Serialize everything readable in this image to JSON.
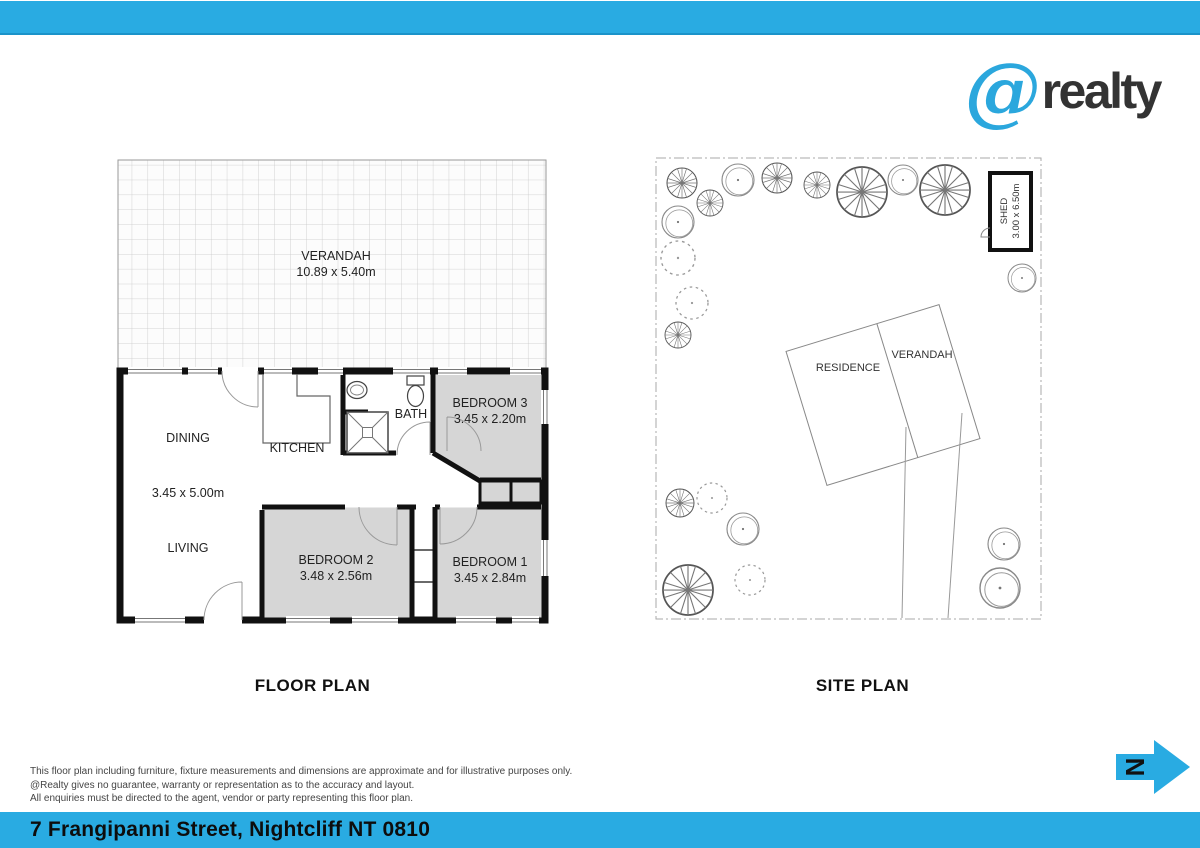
{
  "header": {
    "logo_at": "@",
    "logo_text": "realty"
  },
  "floor_plan": {
    "title": "FLOOR PLAN",
    "verandah": {
      "name": "VERANDAH",
      "dims": "10.89 x 5.40m"
    },
    "rooms": {
      "dining": "DINING",
      "living_dining_dims": "3.45 x 5.00m",
      "living": "LIVING",
      "kitchen": "KITCHEN",
      "bath": "BATH",
      "bedroom3": "BEDROOM 3",
      "bedroom3_dims": "3.45 x 2.20m",
      "bedroom2": "BEDROOM 2",
      "bedroom2_dims": "3.48 x 2.56m",
      "bedroom1": "BEDROOM 1",
      "bedroom1_dims": "3.45 x 2.84m"
    }
  },
  "site_plan": {
    "title": "SITE PLAN",
    "residence_label": "RESIDENCE",
    "verandah_label": "VERANDAH",
    "shed_label": "SHED",
    "shed_dims": "3.00 x 6.50m"
  },
  "north_arrow": {
    "label": "N"
  },
  "disclaimer": {
    "line1": "This floor plan including furniture, fixture measurements and dimensions are approximate and for illustrative purposes only.",
    "line2": "@Realty gives no guarantee, warranty or representation as to the accuracy and layout.",
    "line3": "All enquiries must be directed to the agent, vendor or party representing this floor plan."
  },
  "footer": {
    "address": "7 Frangipanni Street, Nightcliff NT 0810"
  },
  "colors": {
    "accent_blue": "#29ABE2",
    "room_gray": "#d6d6d6"
  }
}
